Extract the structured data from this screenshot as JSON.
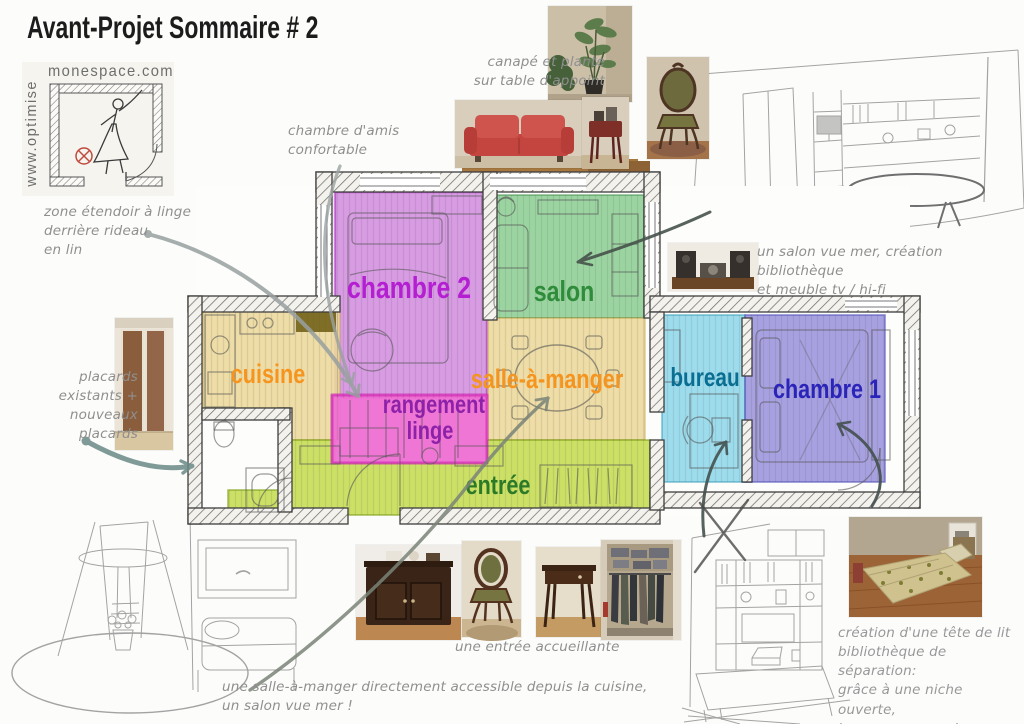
{
  "title": "Avant-Projet Sommaire # 2",
  "logo": {
    "site": "monespace.com",
    "vertical": "www.optimise",
    "symbol_color": "#c04a3e"
  },
  "plan": {
    "rooms": [
      {
        "id": "chambre2",
        "label": "chambre 2",
        "fill": "#d491e0",
        "text_color": "#b31fd1"
      },
      {
        "id": "salon",
        "label": "salon",
        "fill": "#90cf97",
        "text_color": "#2f8c3a"
      },
      {
        "id": "cuisine",
        "label": "cuisine",
        "fill": "#ecd99c",
        "text_color": "#f5941e"
      },
      {
        "id": "salle-a-manger",
        "label": "salle-à-manger",
        "fill": "#ecd99c",
        "text_color": "#f5941e"
      },
      {
        "id": "rangement-linge",
        "label": "rangement linge",
        "fill": "#ef6fd3",
        "text_color": "#8d22a8"
      },
      {
        "id": "entree",
        "label": "entrée",
        "fill": "#c6dd55",
        "text_color": "#2c7a28"
      },
      {
        "id": "bureau",
        "label": "bureau",
        "fill": "#92d8ea",
        "text_color": "#0a6e93"
      },
      {
        "id": "chambre1",
        "label": "chambre 1",
        "fill": "#9e97de",
        "text_color": "#2a24b8"
      }
    ]
  },
  "annotations": [
    {
      "id": "canape",
      "text": "canapé et plante\nsur table d'appoint"
    },
    {
      "id": "chambre-amis",
      "text": "chambre d'amis\nconfortable"
    },
    {
      "id": "zone-etendoir",
      "text": "zone étendoir à linge\nderrière rideau\nen lin"
    },
    {
      "id": "placards",
      "text": "placards\nexistants +\nnouveaux\nplacards"
    },
    {
      "id": "salon-vue-mer",
      "text": "un salon vue mer, création bibliothèque\net meuble tv / hi-fi"
    },
    {
      "id": "entree-accueillante",
      "text": "une entrée accueillante"
    },
    {
      "id": "salle-manger",
      "text": "une salle-à-manger directement accessible depuis la cuisine,\nun salon vue mer !"
    },
    {
      "id": "tete-lit",
      "text": "création d'une tête de lit\nbibliothèque de séparation:\ngrâce à une niche ouverte,\nbureau vue mer !"
    }
  ],
  "photos": [
    {
      "id": "plant"
    },
    {
      "id": "red-sofa"
    },
    {
      "id": "side-table"
    },
    {
      "id": "green-chair-top"
    },
    {
      "id": "hifi"
    },
    {
      "id": "closets"
    },
    {
      "id": "cabinet"
    },
    {
      "id": "green-chair-bottom"
    },
    {
      "id": "desk-table"
    },
    {
      "id": "wardrobe"
    },
    {
      "id": "bed"
    }
  ],
  "sketches": [
    {
      "id": "salon-perspective"
    },
    {
      "id": "entree-perspective"
    },
    {
      "id": "bureau-perspective"
    }
  ]
}
